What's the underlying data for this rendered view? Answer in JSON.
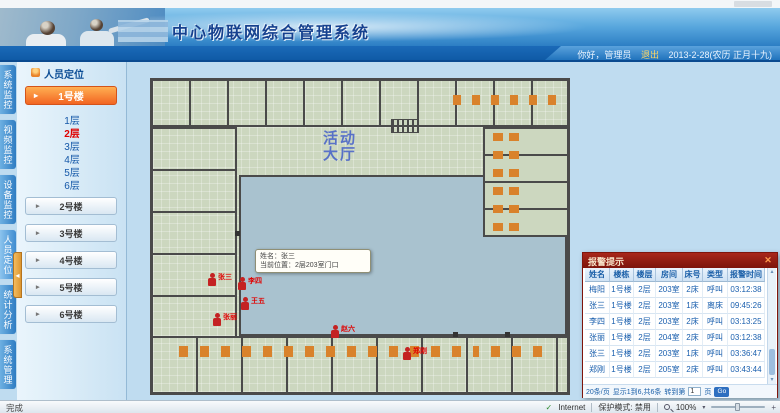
{
  "header": {
    "title": "中心物联网综合管理系统",
    "greeting": "你好，管理员",
    "logout": "退出",
    "date": "2013-2-28(农历 正月十九)"
  },
  "nav_tabs": [
    {
      "label": "系统监控"
    },
    {
      "label": "视频监控"
    },
    {
      "label": "设备监控"
    },
    {
      "label": "人员定位"
    },
    {
      "label": "统计分析"
    },
    {
      "label": "系统管理"
    }
  ],
  "sidebar": {
    "panel_title": "人员定位",
    "buildings": [
      {
        "label": "1号楼",
        "floors": [
          {
            "label": "1层"
          },
          {
            "label": "2层"
          },
          {
            "label": "3层"
          },
          {
            "label": "4层"
          },
          {
            "label": "5层"
          },
          {
            "label": "6层"
          }
        ]
      },
      {
        "label": "2号楼"
      },
      {
        "label": "3号楼"
      },
      {
        "label": "4号楼"
      },
      {
        "label": "5号楼"
      },
      {
        "label": "6号楼"
      }
    ],
    "active_floor": "2层"
  },
  "floorplan": {
    "watermark_line1": "活动",
    "watermark_line2": "大厅",
    "tooltip": {
      "line1": "姓名：张三",
      "line2": "当前位置：2层203室门口"
    },
    "persons": [
      {
        "name": "张三"
      },
      {
        "name": "李四"
      },
      {
        "name": "王五"
      },
      {
        "name": "张丽"
      },
      {
        "name": "赵六"
      },
      {
        "name": "郑刚"
      }
    ]
  },
  "alarm_panel": {
    "title": "报警提示",
    "columns": [
      "姓名",
      "楼栋",
      "楼层",
      "房间",
      "床号",
      "类型",
      "报警时间"
    ],
    "rows": [
      [
        "梅阳",
        "1号楼",
        "2层",
        "203室",
        "2床",
        "呼叫",
        "03:12:38"
      ],
      [
        "张三",
        "1号楼",
        "2层",
        "203室",
        "1床",
        "离床",
        "09:45:26"
      ],
      [
        "李四",
        "1号楼",
        "2层",
        "203室",
        "2床",
        "呼叫",
        "03:13:25"
      ],
      [
        "张丽",
        "1号楼",
        "2层",
        "204室",
        "2床",
        "呼叫",
        "03:12:38"
      ],
      [
        "张三",
        "1号楼",
        "2层",
        "203室",
        "1床",
        "呼叫",
        "03:36:47"
      ],
      [
        "郑刚",
        "1号楼",
        "2层",
        "205室",
        "2床",
        "呼叫",
        "03:43:44"
      ]
    ],
    "pagination": {
      "per_page": "20条/页",
      "info": "显示1到6,共6条",
      "goto_label": "转到第",
      "page_value": "1",
      "page_unit": "页",
      "go_label": "Go"
    }
  },
  "statusbar": {
    "left": "完成",
    "zone": "Internet",
    "protected_mode": "保护模式: 禁用",
    "zoom": "100%"
  },
  "icons": {
    "expand_arrow": "▸",
    "collapse_handle": "◂",
    "close": "✕",
    "scroll_up": "▴",
    "scroll_down": "▾",
    "dropdown": "▾",
    "plus": "+",
    "check": "✓"
  }
}
